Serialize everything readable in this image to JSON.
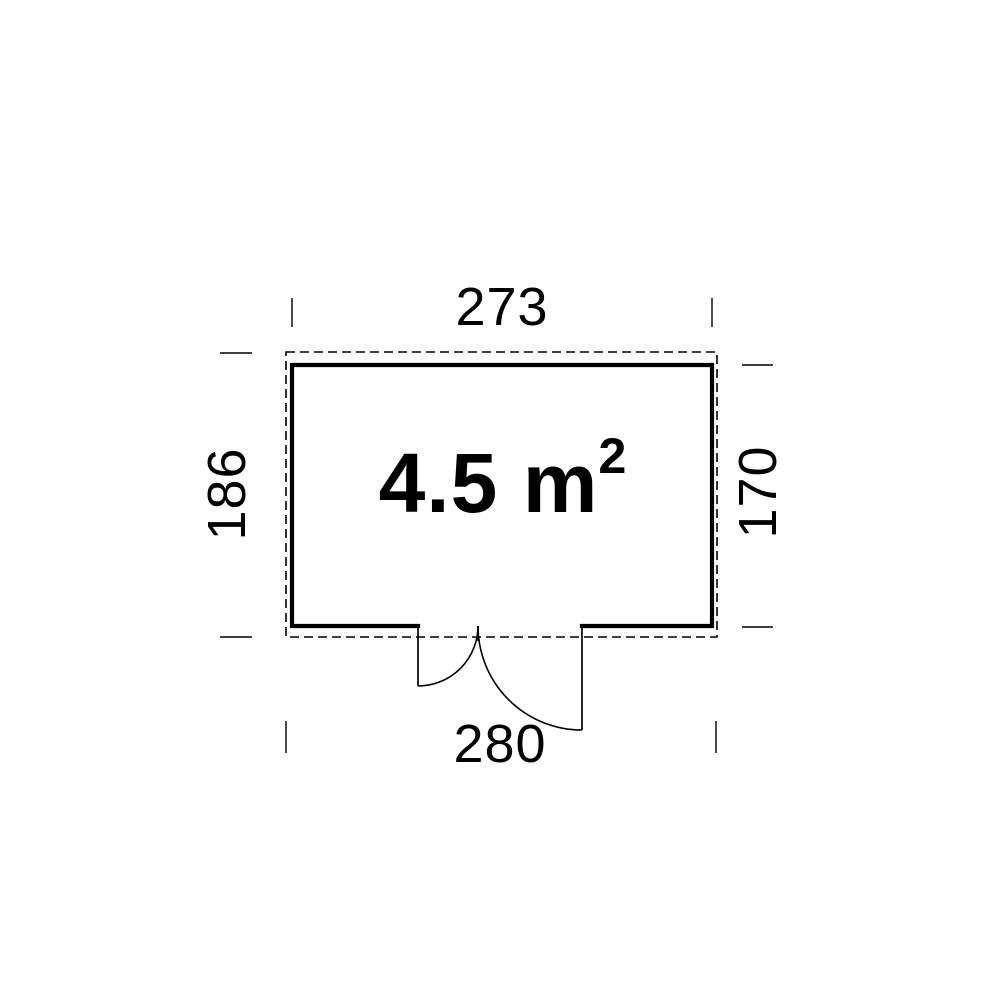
{
  "colors": {
    "background": "#ffffff",
    "line": "#000000",
    "text": "#000000"
  },
  "plan": {
    "kind": "shed-floor-plan",
    "area_label": {
      "text": "4.5 m",
      "exponent": "2"
    },
    "dimensions": {
      "top": "273",
      "bottom": "280",
      "left": "186",
      "right": "170"
    }
  }
}
